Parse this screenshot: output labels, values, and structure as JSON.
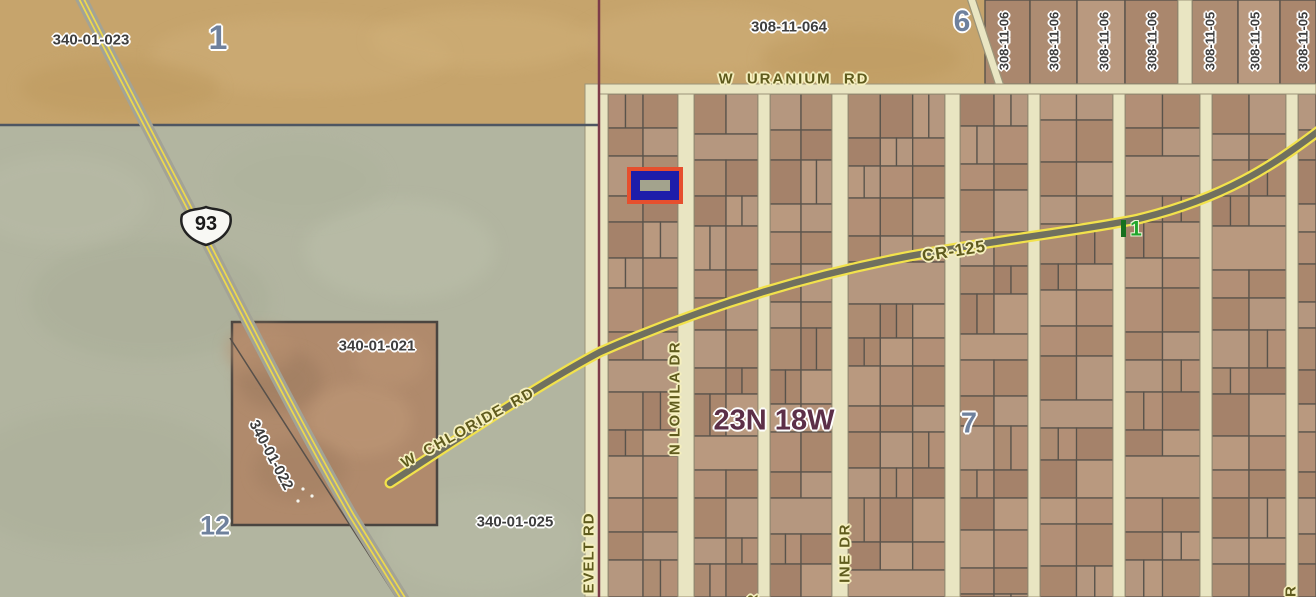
{
  "map": {
    "canvas": {
      "width": 1316,
      "height": 597
    },
    "labels": {
      "p023": "340-01-023",
      "sec1": "1",
      "p064": "308-11-064",
      "sec6": "6",
      "uranium": "W URANIUM RD",
      "strips": [
        "308-11-06",
        "308-11-06",
        "308-11-06",
        "308-11-06",
        "308-11-05",
        "308-11-05",
        "308-11-05"
      ],
      "shield_route": "93",
      "cr125": "CR-125",
      "mile1": "1",
      "chloride": "W CHLORIDE RD",
      "township": "23N 18W",
      "sec7": "7",
      "p021": "340-01-021",
      "p022": "340-01-022",
      "sec12": "12",
      "p025": "340-01-025",
      "roosevelt": "EVELT RD",
      "lomila": "N LOMILA DR",
      "ine_dr": "INE DR",
      "dr_br": "DR",
      "r_part": "R"
    },
    "palette": {
      "tan": "#c6a46c",
      "sage": "#b2b5a0",
      "grid_bg": "#d8d4b0",
      "lot_fills": [
        "#b28f76",
        "#aa876d",
        "#b5977f",
        "#ad8c72",
        "#a5826a",
        "#b9997f"
      ],
      "lot_line": "#59534b",
      "road_fill": "#e9e5c2",
      "road_edge": "#9b9478",
      "boundary_maroon": "#7d3c49",
      "boundary_gray": "#4e5662",
      "us93_pavement": "#a3a396",
      "us93_stripe": "#ecd84e",
      "cr125_edge": "#f2e24c",
      "cr125_center": "#70705f",
      "photo_fill": "#b08a6c",
      "photo_border": "#4a4540",
      "highlight_outer": "#e64f2e",
      "highlight_inner": "#1d1daa",
      "highlight_fill": "#a3a38d",
      "flag_green": "#17701f",
      "shield_fill": "#f8f8f4",
      "shield_line": "#222222"
    },
    "geometry": {
      "regions": [
        {
          "x": 0,
          "y": 0,
          "w": 1316,
          "h": 597,
          "fill": "#b2b5a0"
        },
        {
          "x": 0,
          "y": 0,
          "w": 599,
          "h": 126,
          "fill": "#c6a46c"
        },
        {
          "x": 599,
          "y": 0,
          "w": 717,
          "h": 92,
          "fill": "#c6a46c"
        },
        {
          "x": 599,
          "y": 86,
          "w": 717,
          "h": 511,
          "fill": "#d8d4b0"
        }
      ],
      "strips": {
        "y0": 0,
        "y1": 84,
        "cells": [
          [
            985,
            1030
          ],
          [
            1030,
            1077
          ],
          [
            1077,
            1125
          ],
          [
            1125,
            1178
          ],
          [
            1192,
            1238
          ],
          [
            1238,
            1280
          ],
          [
            1280,
            1316
          ]
        ],
        "road": [
          1178,
          1192
        ]
      },
      "blocks": [
        [
          608,
          678
        ],
        [
          694,
          758
        ],
        [
          770,
          832
        ],
        [
          848,
          945
        ],
        [
          960,
          1028
        ],
        [
          1040,
          1113
        ],
        [
          1125,
          1200
        ],
        [
          1212,
          1286
        ],
        [
          1298,
          1316
        ]
      ],
      "block_area": [
        94,
        597
      ],
      "row_pattern": [
        34,
        28,
        40,
        26,
        36,
        30,
        44,
        28,
        32,
        38,
        26,
        42
      ],
      "v_roads": [
        [
          585,
          608
        ],
        [
          678,
          694
        ],
        [
          758,
          770
        ],
        [
          832,
          848
        ],
        [
          945,
          960
        ],
        [
          1028,
          1040
        ],
        [
          1113,
          1125
        ],
        [
          1200,
          1212
        ],
        [
          1286,
          1298
        ]
      ],
      "h_road": [
        599,
        84,
        1316,
        94
      ],
      "diag_road": "M 971,-2 L 1000,86",
      "boundary_v_x": 599,
      "boundary_h": [
        0,
        125,
        599
      ],
      "photo_parcel": [
        232,
        322,
        205,
        203
      ],
      "photo_track": "M 230,338 L 398,600",
      "us93_path": "M 78,-8 C 130,95 175,180 215,258 C 252,330 300,425 352,516 L 404,600",
      "cr125_path": "M 390,483 C 470,431 540,384 600,352 C 705,306 810,275 910,256 C 1010,238 1085,230 1138,219 C 1225,198 1272,166 1320,130",
      "highlight": [
        627,
        167,
        56,
        37
      ],
      "shield_center": [
        206,
        223
      ],
      "flag_rect": [
        1121,
        220,
        5,
        17
      ]
    }
  }
}
